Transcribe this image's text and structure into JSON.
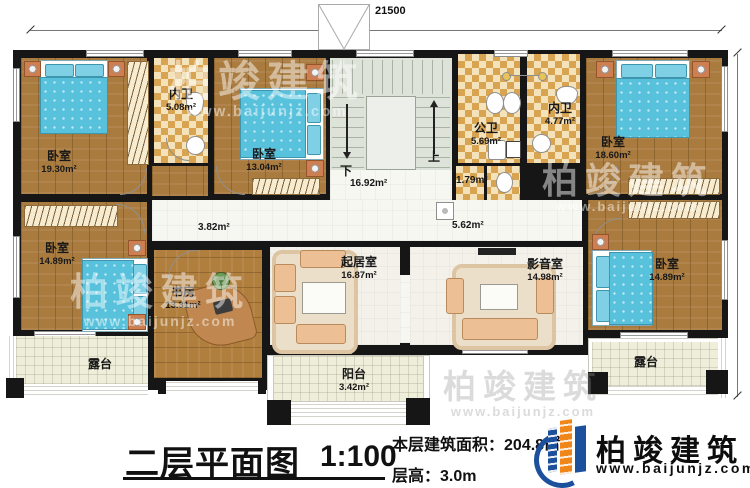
{
  "dimensions": {
    "top": "21500",
    "right": "11000"
  },
  "stairs": {
    "up": "上",
    "down": "下",
    "area": "16.92m²"
  },
  "hall": {
    "area_left": "3.82m²",
    "area_right": "5.62m²",
    "wc_area": "1.79m²"
  },
  "rooms": [
    {
      "id": "bedroom-tl",
      "name": "卧室",
      "area": "19.30m²"
    },
    {
      "id": "ensuite-tl",
      "name": "内卫",
      "area": "5.08m²"
    },
    {
      "id": "bedroom-tc",
      "name": "卧室",
      "area": "13.04m²"
    },
    {
      "id": "public-bath",
      "name": "公卫",
      "area": "5.69m²"
    },
    {
      "id": "ensuite-tr",
      "name": "内卫",
      "area": "4.77m²"
    },
    {
      "id": "bedroom-tr",
      "name": "卧室",
      "area": "18.60m²"
    },
    {
      "id": "bedroom-ml",
      "name": "卧室",
      "area": "14.89m²"
    },
    {
      "id": "study",
      "name": "书房",
      "area": "13.31m²"
    },
    {
      "id": "living",
      "name": "起居室",
      "area": "16.87m²"
    },
    {
      "id": "media",
      "name": "影音室",
      "area": "14.98m²"
    },
    {
      "id": "bedroom-br",
      "name": "卧室",
      "area": "14.89m²"
    },
    {
      "id": "terrace-left",
      "name": "露台",
      "area": ""
    },
    {
      "id": "balcony",
      "name": "阳台",
      "area": "3.42m²"
    },
    {
      "id": "terrace-right",
      "name": "露台",
      "area": ""
    }
  ],
  "titleblock": {
    "title": "二层平面图",
    "scale": "1:100",
    "area_label": "本层建筑面积：",
    "area_value": "204.8㎡",
    "height_label": "层高：",
    "height_value": "3.0m"
  },
  "brand": {
    "name": "柏竣建筑",
    "site": "www.baijunjz.com"
  },
  "colors": {
    "brand_blue": "#1c4f9c",
    "brand_orange": "#f08519",
    "wall": "#161616"
  }
}
